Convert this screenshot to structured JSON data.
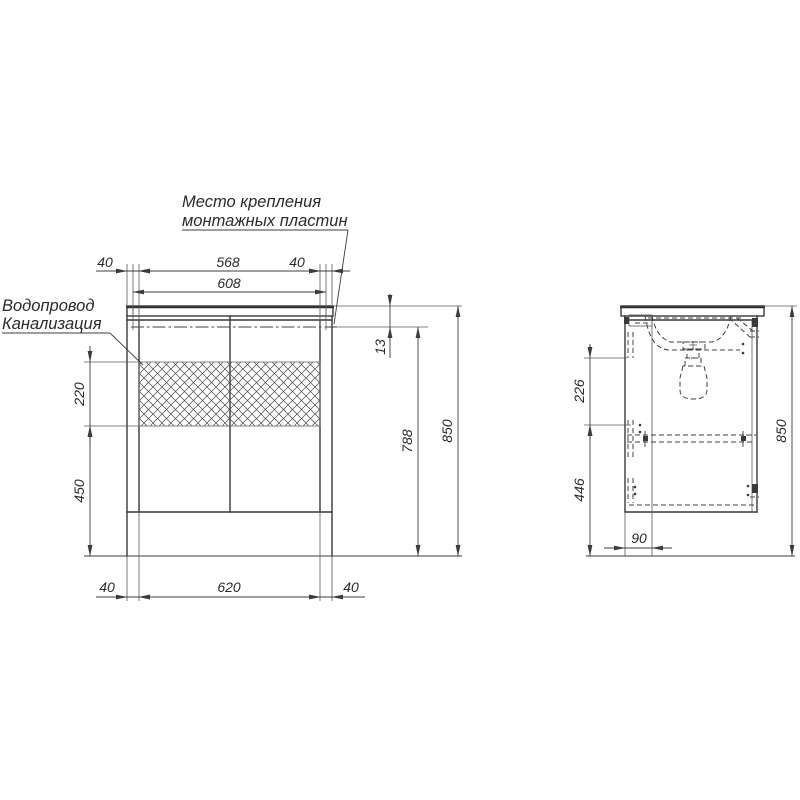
{
  "labels": {
    "mounting_note_line1": "Место крепления",
    "mounting_note_line2": "монтажных пластин",
    "water_supply": "Водопровод",
    "sewerage": "Канализация"
  },
  "front_view": {
    "top_dims": {
      "left_offset": "40",
      "plate_span": "568",
      "right_offset": "40",
      "outer_span": "608"
    },
    "left_dims": {
      "service_window_height": "220",
      "lower_section": "450"
    },
    "right_dims": {
      "top_offset": "13",
      "mount_height": "788",
      "total_height": "850"
    },
    "bottom_dims": {
      "left_offset": "40",
      "body_width": "620",
      "right_offset": "40"
    }
  },
  "side_view": {
    "upper_section": "226",
    "lower_section": "446",
    "depth_offset": "90",
    "total_height": "850"
  },
  "colors": {
    "line_color": "#3a3a3a",
    "background": "#ffffff"
  }
}
